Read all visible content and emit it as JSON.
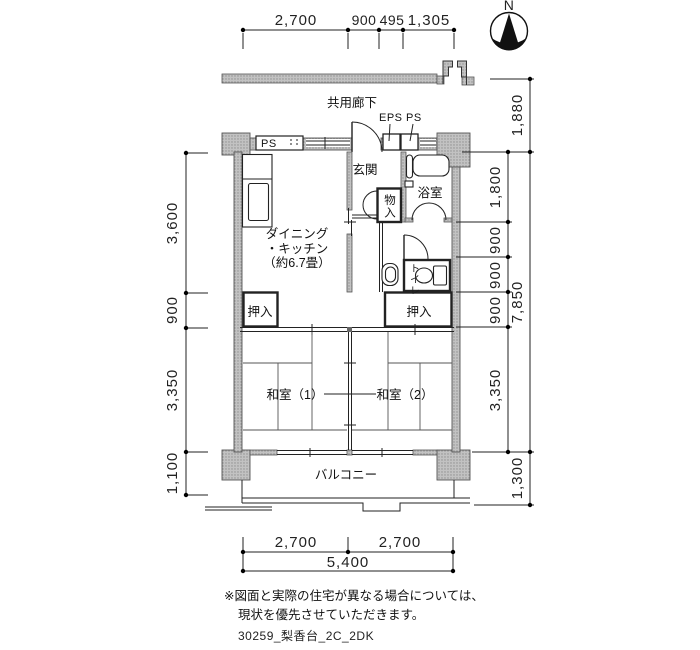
{
  "compass": {
    "north_label": "N"
  },
  "corridor": {
    "label": "共用廊下"
  },
  "shafts": {
    "eps_label": "EPS",
    "ps_label": "PS",
    "ps_wall_label": "PS"
  },
  "rooms": {
    "entrance": "玄関",
    "dk_line1": "ダイニング",
    "dk_line2": "・キッチン",
    "dk_line3": "（約6.7畳）",
    "storage": "物入",
    "bath": "浴室",
    "toilet": "トイレ",
    "closet_left": "押入",
    "closet_right": "押入",
    "washitsu1": "和室（1）",
    "washitsu2": "和室（2）",
    "balcony": "バルコニー"
  },
  "dims": {
    "top": [
      "2,700",
      "900",
      "495",
      "1,305"
    ],
    "left": [
      "3,600",
      "900",
      "3,350",
      "1,100"
    ],
    "right_inner": [
      "1,800",
      "900",
      "900",
      "900",
      "3,350"
    ],
    "right_outer": [
      "1,880",
      "7,850",
      "1,300"
    ],
    "bottom_segments": [
      "2,700",
      "2,700"
    ],
    "bottom_total": "5,400"
  },
  "note": {
    "line1": "※図面と実際の住宅が異なる場合については、",
    "line2": "現状を優先させていただきます。",
    "drawing_id": "30259_梨香台_2C_2DK"
  }
}
